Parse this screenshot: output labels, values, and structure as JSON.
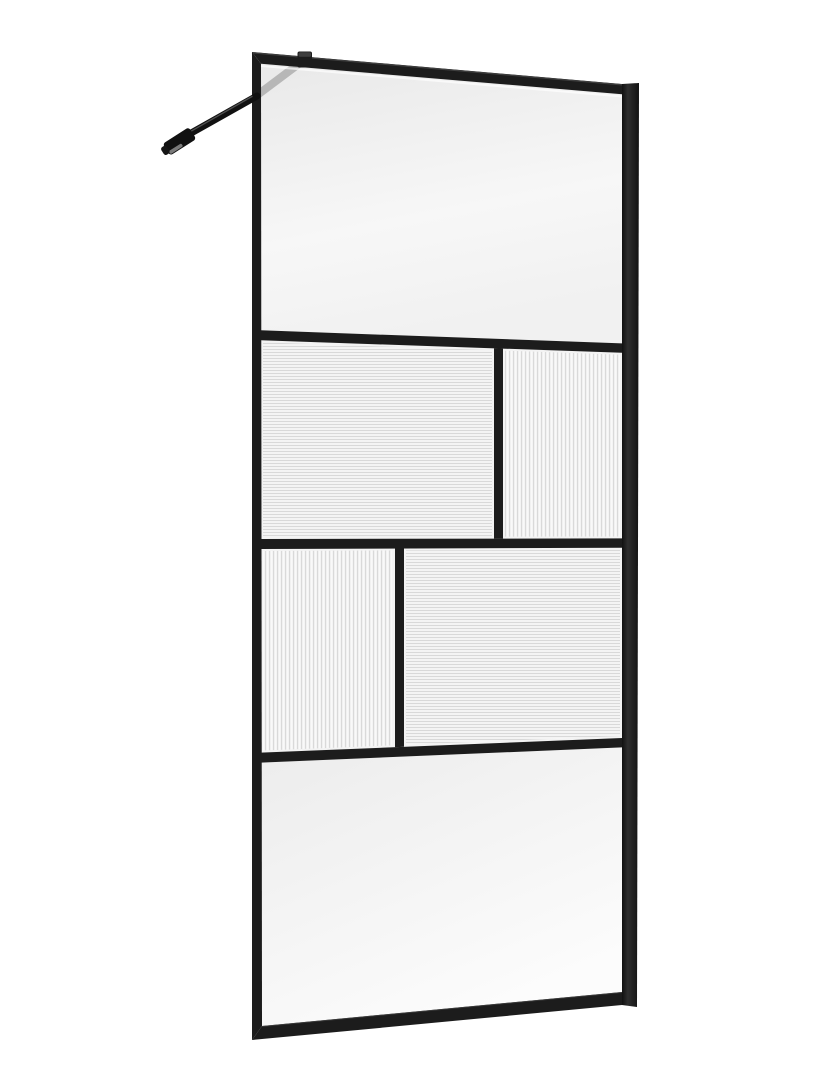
{
  "meta": {
    "description": "Product photo: black-framed walk-in shower glass screen, shown at a slight angle on a white background. Grid of clear and fluted glass panels with a diagonal wall support bar at the top left."
  },
  "colors": {
    "background": "#ffffff",
    "frame": "#1c1c1c",
    "frame_dark": "#111111",
    "frame_highlight": "#3e3e3e",
    "profile_mid": "#2e2e2e",
    "glass_top_dark": "#e9e9e9",
    "glass_top_light": "#f7f7f7",
    "glass_bottom_dark": "#ececec",
    "glass_bottom_light": "#fcfcfc",
    "flute_bg": "#f9f9f9",
    "flute_stripe": "#d9d9d9",
    "panel_margin": "#f3f3f3",
    "reflection": "#b7b7b7",
    "glass_edge_highlight": "#ffffff",
    "bracket_metal": "#7a7a7a"
  },
  "parts": {
    "support_bar": "wall support bar",
    "wall_bracket": "wall bracket",
    "glass_clamp": "support bar glass clamp",
    "top_rail": "top frame rail",
    "bottom_rail": "bottom frame rail",
    "left_stile": "left frame stile",
    "wall_profile": "right wall mounting profile",
    "mullion_1": "horizontal mullion 1",
    "mullion_2": "horizontal mullion 2",
    "mullion_3": "horizontal mullion 3",
    "vmullion_row2": "vertical mullion row 2",
    "vmullion_row3": "vertical mullion row 3",
    "top_panel": "clear glass panel (top)",
    "row2_left_panel": "fluted glass panel, horizontal ribs (row 2 left)",
    "row2_right_panel": "fluted glass panel, vertical ribs (row 2 right)",
    "row3_left_panel": "fluted glass panel, vertical ribs (row 3 left)",
    "row3_right_panel": "fluted glass panel, horizontal ribs (row 3 right)",
    "bottom_panel": "clear glass panel (bottom)"
  }
}
